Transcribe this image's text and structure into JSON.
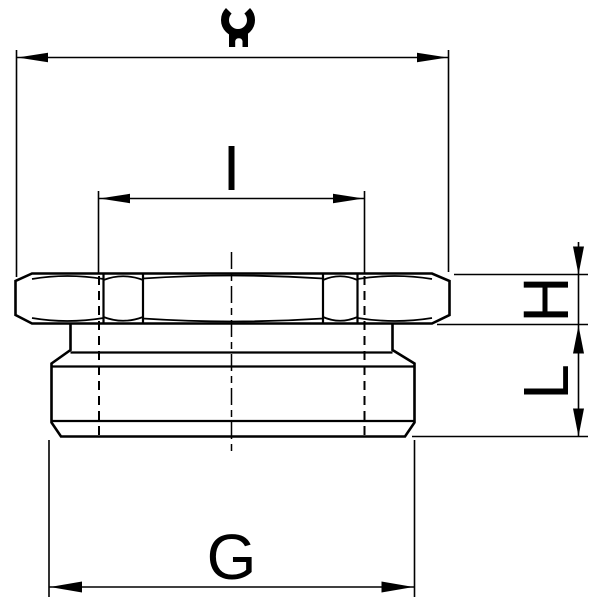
{
  "drawing": {
    "kind": "technical-dimension-drawing",
    "labels": {
      "inner_thread": "I",
      "nut_height": "H",
      "body_length": "L",
      "outer_thread": "G"
    },
    "icons": {
      "wrench": "open-end-wrench"
    },
    "colors": {
      "line": "#000000",
      "background": "#ffffff"
    }
  }
}
